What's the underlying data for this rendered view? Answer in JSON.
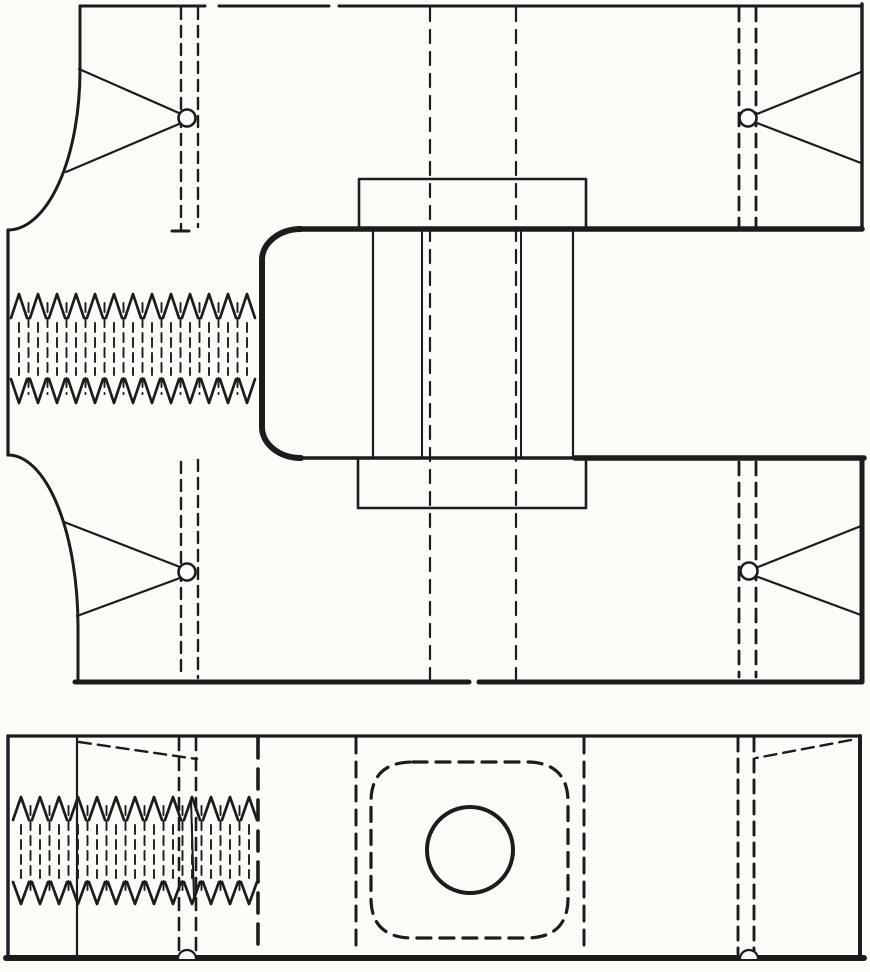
{
  "colors": {
    "ink": "#1c1c1c",
    "paper": "#fcfbf8"
  },
  "figure": {
    "type": "engineering-line-drawing",
    "view_count": 2
  }
}
